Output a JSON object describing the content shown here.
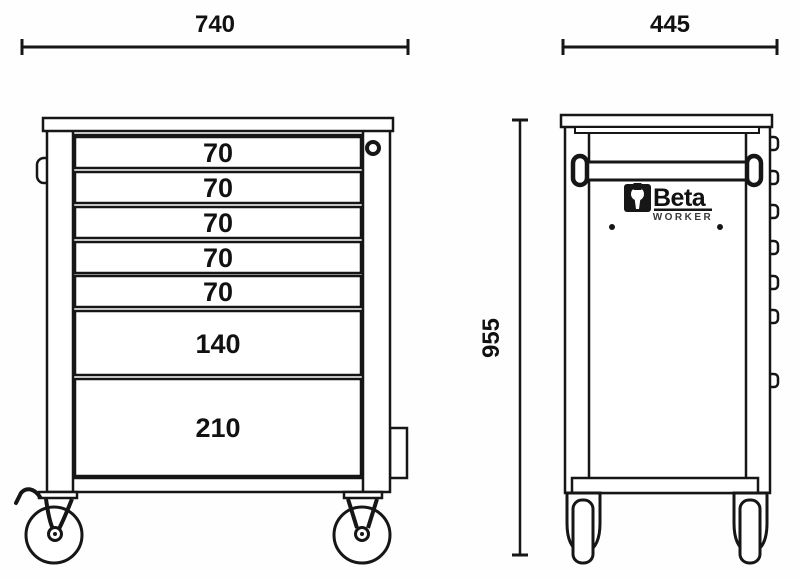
{
  "meta": {
    "background_color": "#fefefe",
    "line_color": "#161616",
    "drawing_type": "technical dimension drawing of a 7-drawer tool trolley"
  },
  "dimensions": {
    "front_width": "740",
    "side_depth": "445",
    "side_height": "955"
  },
  "front_view": {
    "drawers": [
      {
        "label": "70"
      },
      {
        "label": "70"
      },
      {
        "label": "70"
      },
      {
        "label": "70"
      },
      {
        "label": "70"
      },
      {
        "label": "140"
      },
      {
        "label": "210"
      }
    ]
  },
  "side_view": {
    "brand": "Beta",
    "brand_sub": "WORKER"
  },
  "icons": {
    "lock": "ring-circle",
    "brake_lever": "zigzag-hook",
    "wrench": "beta-wrench-glyph"
  }
}
